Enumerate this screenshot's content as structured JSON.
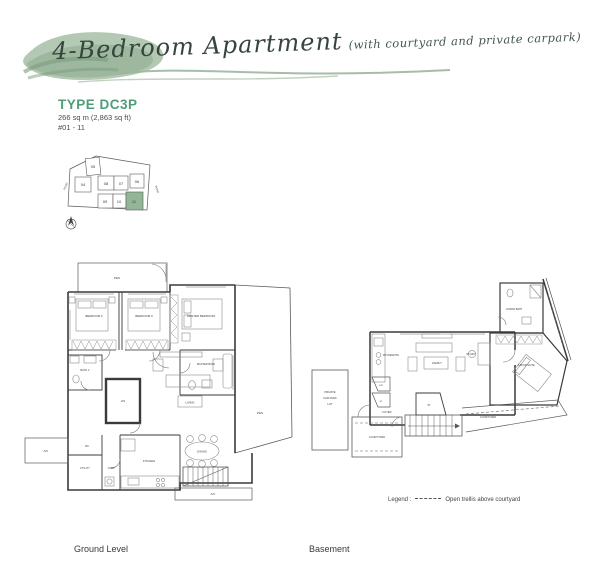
{
  "header": {
    "title": "4-Bedroom Apartment",
    "subtitle": "(with courtyard and private carpark)"
  },
  "unit": {
    "type_label": "TYPE DC3P",
    "area": "266 sq m (2,863 sq ft)",
    "stack": "#01 - 11"
  },
  "keyplan": {
    "blocks": [
      "05",
      "04",
      "08",
      "07",
      "06",
      "09",
      "10",
      "11"
    ],
    "highlighted_block": "11",
    "highlight_color": "#93b796",
    "road_left": "ROAD",
    "road_right": "ROAD"
  },
  "ground": {
    "labels": {
      "pes_top": "PES",
      "pes_right": "PES",
      "bedroom2": "BEDROOM 2",
      "bedroom3": "BEDROOM 3",
      "master_bedroom": "MASTER BEDROOM",
      "master_bath": "MASTER BATH",
      "bath2": "BATH 2",
      "hs": "HS",
      "living": "LIVING",
      "dining": "DINING",
      "kitchen": "KITCHEN",
      "yard": "YARD",
      "utility": "UTILITY",
      "wc": "WC",
      "ac_left": "A/C",
      "ac_bottom": "A/C"
    }
  },
  "basement": {
    "labels": {
      "kitchenette": "KITCHENETTE",
      "family": "FAMILY",
      "study": "STUDY",
      "junior_bath": "JUNIOR BATH",
      "junior_suite": "JUNIOR SUITE",
      "private_carpark_l1": "PRIVATE",
      "private_carpark_l2": "CAR PARK",
      "private_carpark_l3": "LOT",
      "foyer": "FOYER",
      "courtyard_left": "COURTYARD",
      "courtyard_right": "COURTYARD",
      "dw": "DW",
      "st_closet": "ST",
      "st_stairs": "ST"
    }
  },
  "legend": {
    "label": "Legend :",
    "item": "Open trellis above courtyard"
  },
  "captions": {
    "ground": "Ground Level",
    "basement": "Basement"
  },
  "colors": {
    "brand_green": "#4f9d78",
    "brush_sage": "#a6bfa6"
  }
}
